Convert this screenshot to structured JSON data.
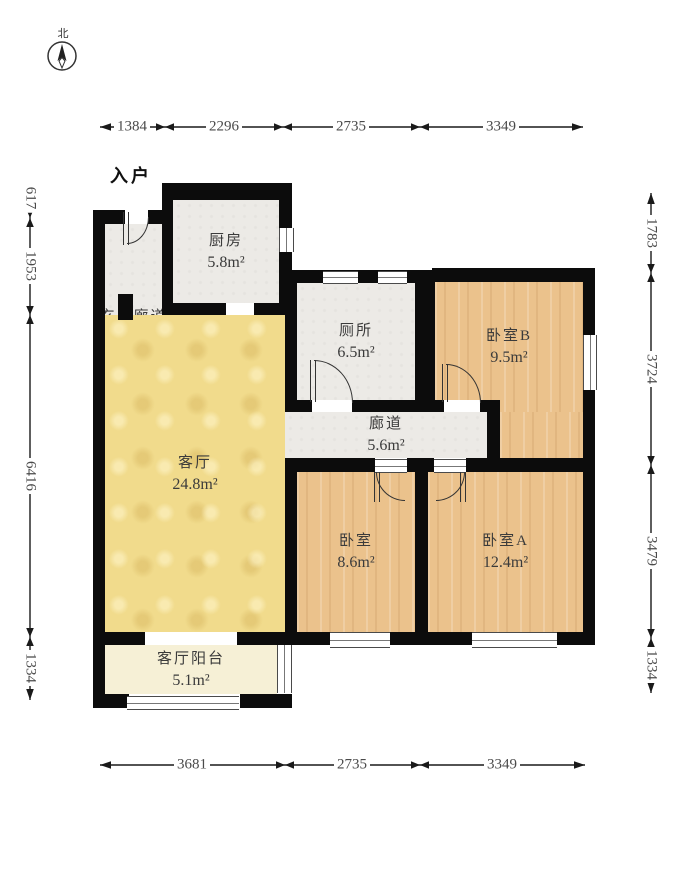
{
  "compass": {
    "north_label": "北"
  },
  "entrance_label": "入户",
  "rooms": {
    "hallway": {
      "label": "玄关廊道",
      "area": "2.8m²"
    },
    "kitchen": {
      "label": "厨房",
      "area": "5.8m²"
    },
    "toilet": {
      "label": "厕所",
      "area": "6.5m²"
    },
    "corridor": {
      "label": "廊道",
      "area": "5.6m²"
    },
    "bedroom_b": {
      "label": "卧室B",
      "area": "9.5m²"
    },
    "living": {
      "label": "客厅",
      "area": "24.8m²"
    },
    "bedroom": {
      "label": "卧室",
      "area": "8.6m²"
    },
    "bedroom_a": {
      "label": "卧室A",
      "area": "12.4m²"
    },
    "balcony": {
      "label": "客厅阳台",
      "area": "5.1m²"
    }
  },
  "dimensions": {
    "top": [
      "1384",
      "2296",
      "2735",
      "3349"
    ],
    "bottom": [
      "3681",
      "2735",
      "3349"
    ],
    "left": [
      "617",
      "1953",
      "6416",
      "1334"
    ],
    "right": [
      "1783",
      "3724",
      "3479",
      "1334"
    ]
  },
  "colors": {
    "living_fill": "#f1db8c",
    "wood_fill": "#ebc28c",
    "gray_fill": "#eceae6",
    "balcony_fill": "#f6f0d6",
    "wall": "#0c0c0c",
    "dimension_line": "#1a1a1a"
  }
}
